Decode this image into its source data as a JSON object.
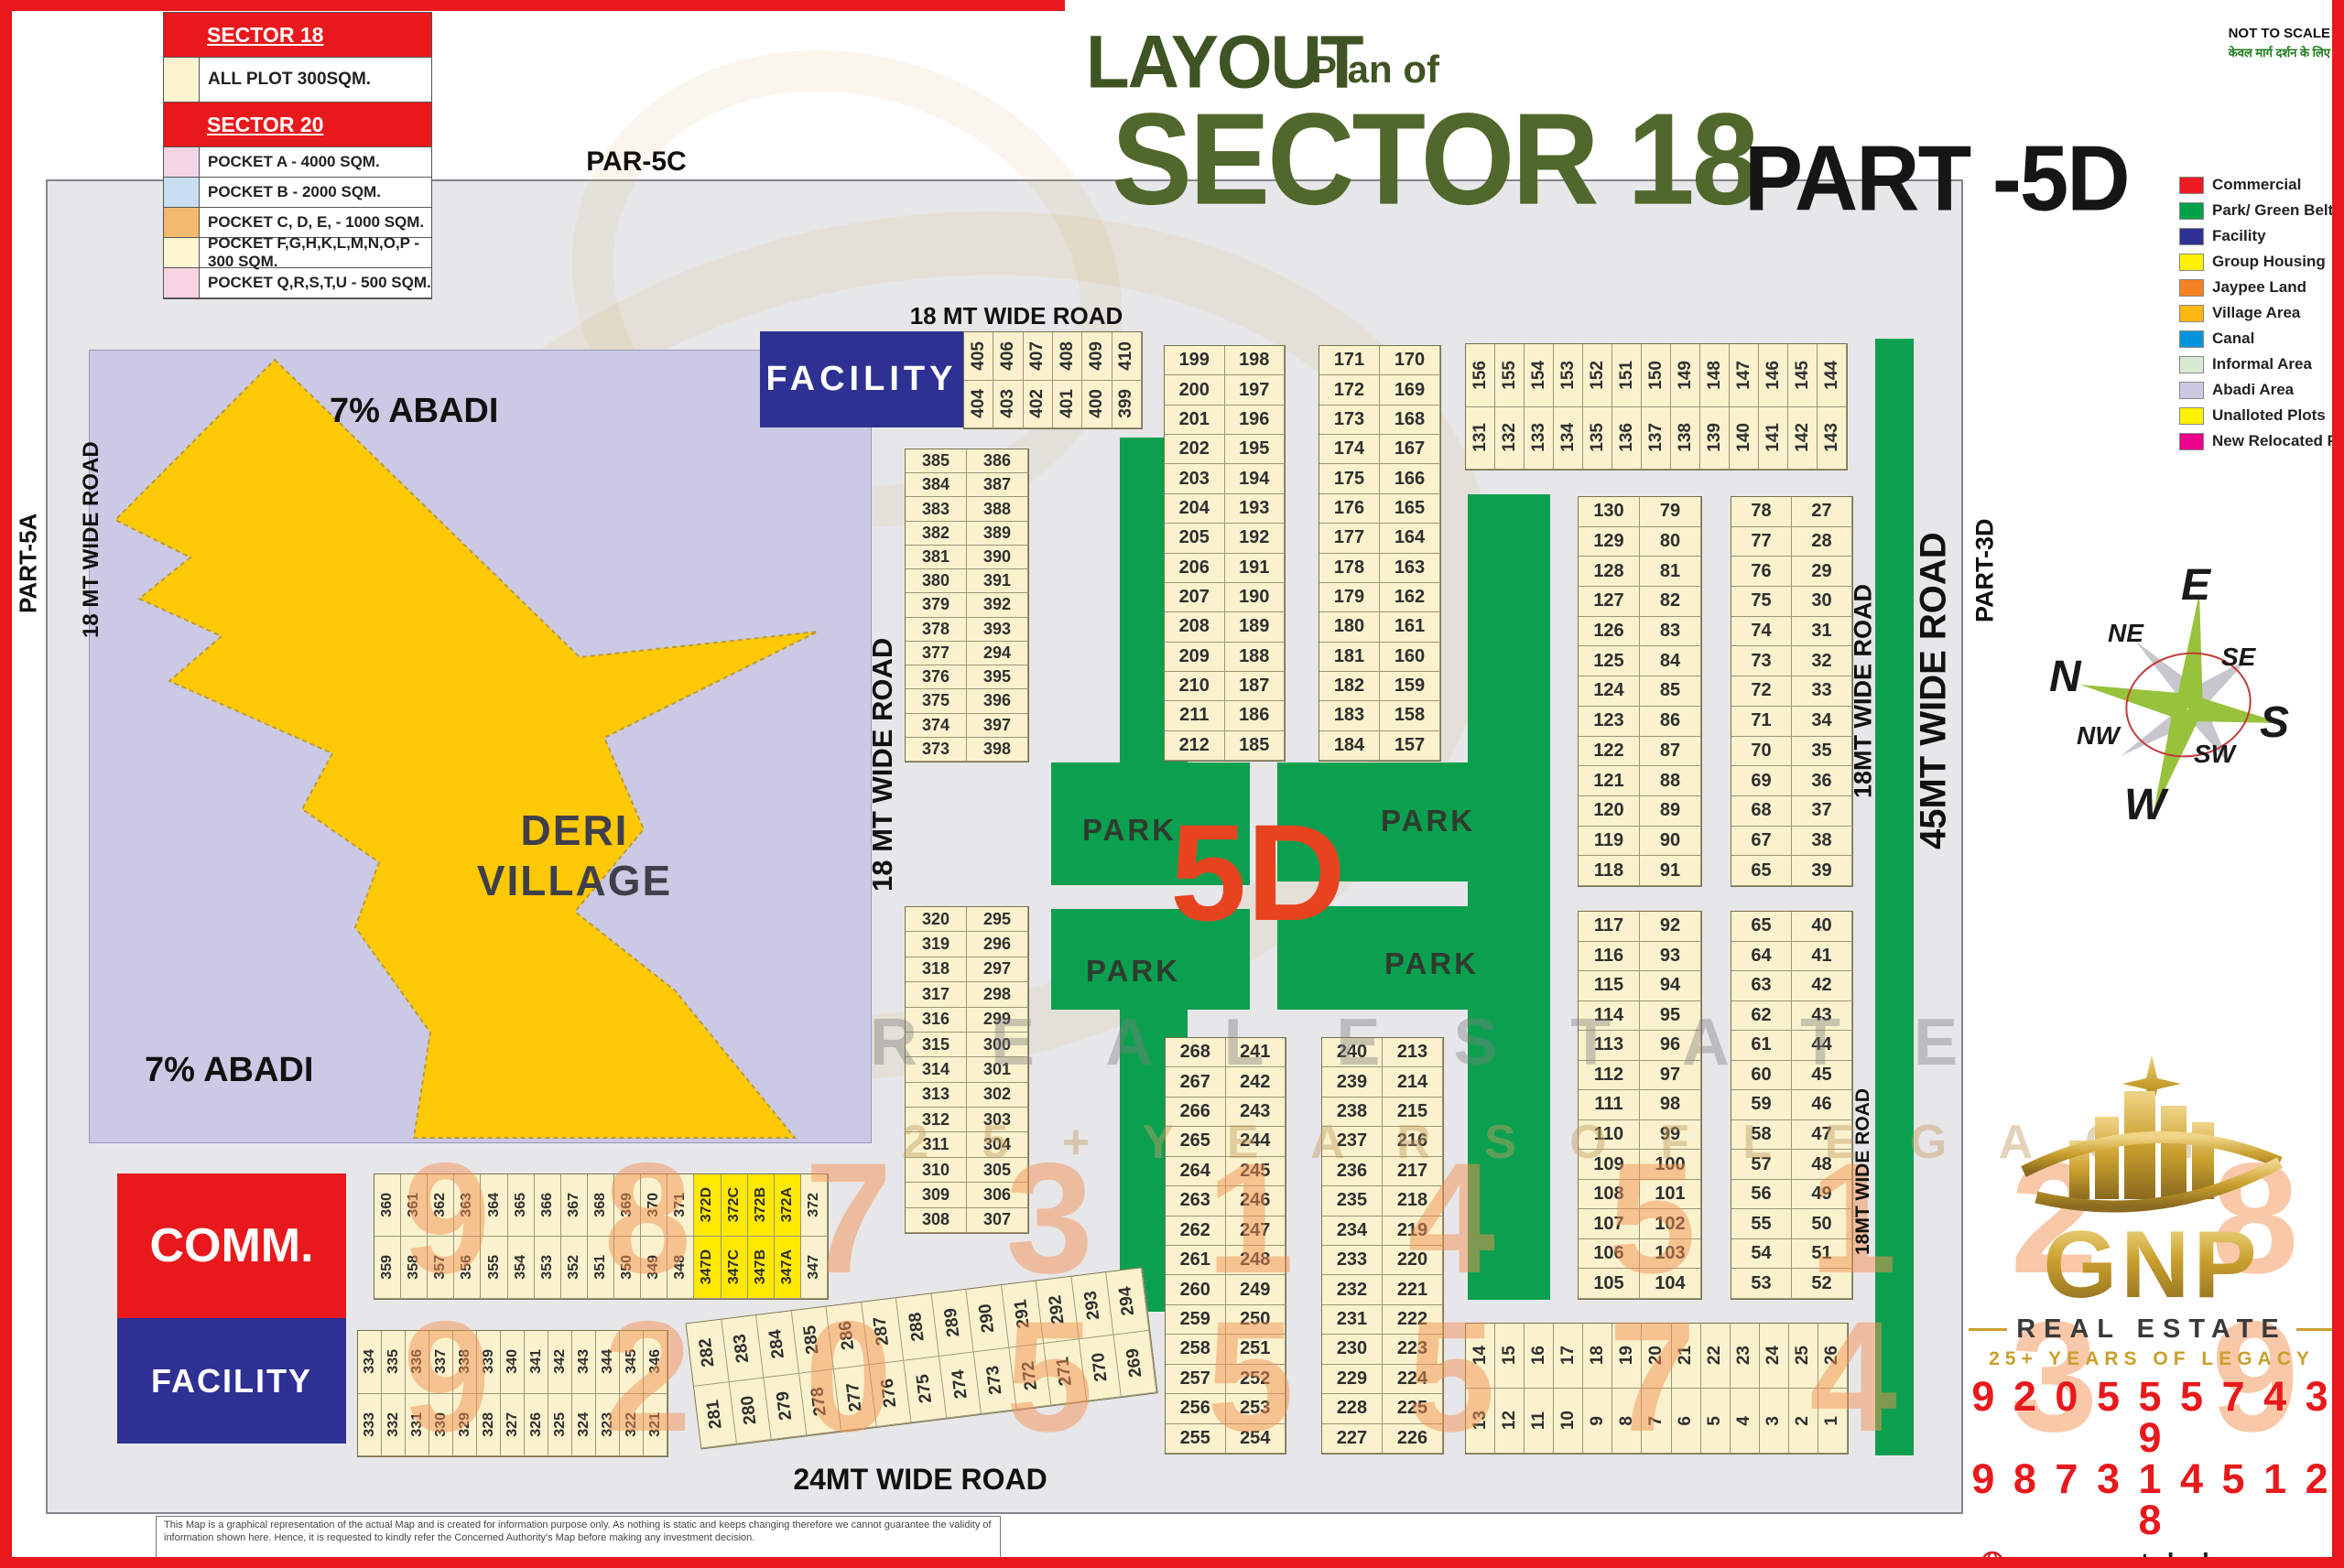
{
  "title": {
    "layout": "LAYOUT",
    "plan_of": "Plan of",
    "sector": "SECTOR 18",
    "part": "PART -5D",
    "not_to_scale": "NOT TO SCALE",
    "hindi_note": "केवल मार्ग दर्शन के लिए"
  },
  "legend_left": {
    "rows": [
      {
        "type": "header",
        "text": "SECTOR 18"
      },
      {
        "type": "item",
        "tall": true,
        "swatch": "#fbf3cf",
        "text": "ALL PLOT  300SQM."
      },
      {
        "type": "header",
        "text": "SECTOR 20"
      },
      {
        "type": "item",
        "swatch": "#f5d5e5",
        "text": "POCKET A    -   4000 SQM."
      },
      {
        "type": "item",
        "swatch": "#c9def0",
        "text": "POCKET B    -   2000 SQM."
      },
      {
        "type": "item",
        "swatch": "#f5b96e",
        "text": "POCKET C, D, E, - 1000 SQM."
      },
      {
        "type": "item",
        "swatch": "#fdf6d0",
        "text": "POCKET   F,G,H,K,L,M,N,O,P  -  300 SQM."
      },
      {
        "type": "item",
        "swatch": "#f8d3e2",
        "text": "POCKET Q,R,S,T,U   -   500 SQM."
      }
    ]
  },
  "legend_right": {
    "items": [
      {
        "color": "#ed1c24",
        "label": "Commercial"
      },
      {
        "color": "#00a14b",
        "label": "Park/ Green Belt"
      },
      {
        "color": "#2e3192",
        "label": "Facility"
      },
      {
        "color": "#fff200",
        "label": "Group Housing"
      },
      {
        "color": "#f58220",
        "label": "Jaypee Land"
      },
      {
        "color": "#fcb913",
        "label": "Village Area"
      },
      {
        "color": "#0095da",
        "label": "Canal"
      },
      {
        "color": "#d9ead3",
        "label": "Informal Area"
      },
      {
        "color": "#ccc9e2",
        "label": "Abadi Area"
      },
      {
        "color": "#fff200",
        "label": "Unalloted Plots"
      },
      {
        "color": "#ec008c",
        "label": "New Relocated Plots"
      }
    ]
  },
  "labels": {
    "par5c": "PAR-5C",
    "road_top": "18 MT WIDE ROAD",
    "part5a": "PART-5A",
    "road_left": "18 MT WIDE ROAD",
    "road_center": "18 MT WIDE ROAD",
    "abadi_top": "7% ABADI",
    "abadi_bottom": "7% ABADI",
    "deri_line1": "DERI",
    "deri_line2": "VILLAGE",
    "comm": "COMM.",
    "facility": "FACILITY",
    "park": "PARK",
    "five_d": "5D",
    "road18_right_1": "18MT WIDE ROAD",
    "road18_right_2": "18MT WIDE ROAD",
    "road_45": "45MT WIDE ROAD",
    "part3d": "PART-3D",
    "road_24": "24MT WIDE ROAD",
    "part_j": "PART-J",
    "disclaimer": "This Map is a graphical representation of the actual Map and is created for information purpose only. As nothing is static and keeps changing therefore we cannot guarantee the validity of information shown here. Hence, it is requested to kindly refer the Concerned Authority's Map before making any investment decision."
  },
  "compass": {
    "n": "N",
    "e": "E",
    "s": "S",
    "w": "W",
    "ne": "NE",
    "se": "SE",
    "sw": "SW",
    "nw": "NW"
  },
  "watermarks": {
    "line1": "R E A L   E S T A T E",
    "line2": "2 5 +   Y E A R S   O F   L E G A C Y",
    "num1": "9 8 7 3 1 4 5 1 2 8",
    "num2": "9 2 0 5 5 5 7 4 3 9"
  },
  "footer": {
    "brand": "GNP",
    "tagline": "REAL ESTATE",
    "legacy": "25+ YEARS OF LEGACY",
    "phone1": "9 2 0 5 5  5 7 4 3 9",
    "phone2": "9 8 7 3 1 4 5 1 2 8",
    "website": "gnpropertyhub.com",
    "email": "Support@gnpropertyhub.com"
  },
  "blocks": {
    "b1": {
      "left": [
        "385",
        "384",
        "383",
        "382",
        "381",
        "380",
        "379",
        "378",
        "377",
        "376",
        "375",
        "374",
        "373"
      ],
      "right": [
        "386",
        "387",
        "388",
        "389",
        "390",
        "391",
        "392",
        "393",
        "294",
        "395",
        "396",
        "397",
        "398"
      ]
    },
    "b2": {
      "left": [
        "320",
        "319",
        "318",
        "317",
        "316",
        "315",
        "314",
        "313",
        "312",
        "311",
        "310",
        "309",
        "308"
      ],
      "right": [
        "295",
        "296",
        "297",
        "298",
        "299",
        "300",
        "301",
        "302",
        "303",
        "304",
        "305",
        "306",
        "307"
      ]
    },
    "bA": {
      "left": [
        "199",
        "200",
        "201",
        "202",
        "203",
        "204",
        "205",
        "206",
        "207",
        "208",
        "209",
        "210",
        "211",
        "212"
      ],
      "right": [
        "198",
        "197",
        "196",
        "195",
        "194",
        "193",
        "192",
        "191",
        "190",
        "189",
        "188",
        "187",
        "186",
        "185"
      ]
    },
    "bB": {
      "left": [
        "171",
        "172",
        "173",
        "174",
        "175",
        "176",
        "177",
        "178",
        "179",
        "180",
        "181",
        "182",
        "183",
        "184"
      ],
      "right": [
        "170",
        "169",
        "168",
        "167",
        "166",
        "165",
        "164",
        "163",
        "162",
        "161",
        "160",
        "159",
        "158",
        "157"
      ]
    },
    "bC": {
      "left": [
        "130",
        "129",
        "128",
        "127",
        "126",
        "125",
        "124",
        "123",
        "122",
        "121",
        "120",
        "119",
        "118"
      ],
      "right": [
        "79",
        "80",
        "81",
        "82",
        "83",
        "84",
        "85",
        "86",
        "87",
        "88",
        "89",
        "90",
        "91"
      ]
    },
    "bD": {
      "left": [
        "78",
        "77",
        "76",
        "75",
        "74",
        "73",
        "72",
        "71",
        "70",
        "69",
        "68",
        "67",
        "65"
      ],
      "right": [
        "27",
        "28",
        "29",
        "30",
        "31",
        "32",
        "33",
        "34",
        "35",
        "36",
        "37",
        "38",
        "39"
      ]
    },
    "bE": {
      "left": [
        "117",
        "116",
        "115",
        "114",
        "113",
        "112",
        "111",
        "110",
        "109",
        "108",
        "107",
        "106",
        "105"
      ],
      "right": [
        "92",
        "93",
        "94",
        "95",
        "96",
        "97",
        "98",
        "99",
        "100",
        "101",
        "102",
        "103",
        "104"
      ]
    },
    "bF": {
      "left": [
        "65",
        "64",
        "63",
        "62",
        "61",
        "60",
        "59",
        "58",
        "57",
        "56",
        "55",
        "54",
        "53"
      ],
      "right": [
        "40",
        "41",
        "42",
        "43",
        "44",
        "45",
        "46",
        "47",
        "48",
        "49",
        "50",
        "51",
        "52"
      ]
    },
    "bG": {
      "left": [
        "268",
        "267",
        "266",
        "265",
        "264",
        "263",
        "262",
        "261",
        "260",
        "259",
        "258",
        "257",
        "256",
        "255"
      ],
      "right": [
        "241",
        "242",
        "243",
        "244",
        "245",
        "246",
        "247",
        "248",
        "249",
        "250",
        "251",
        "252",
        "253",
        "254"
      ]
    },
    "bH": {
      "left": [
        "240",
        "239",
        "238",
        "237",
        "236",
        "235",
        "234",
        "233",
        "232",
        "231",
        "230",
        "229",
        "228",
        "227"
      ],
      "right": [
        "213",
        "214",
        "215",
        "216",
        "217",
        "218",
        "219",
        "220",
        "221",
        "222",
        "223",
        "224",
        "225",
        "226"
      ]
    }
  },
  "strips": {
    "s405": {
      "top": [
        "405",
        "406",
        "407",
        "408",
        "409",
        "410"
      ],
      "bottom": [
        "404",
        "403",
        "402",
        "401",
        "400",
        "399"
      ]
    },
    "s131": {
      "top": [
        "156",
        "155",
        "154",
        "153",
        "152",
        "151",
        "150",
        "149",
        "148",
        "147",
        "146",
        "145",
        "144"
      ],
      "bottom": [
        "131",
        "132",
        "133",
        "134",
        "135",
        "136",
        "137",
        "138",
        "139",
        "140",
        "141",
        "142",
        "143"
      ]
    },
    "s360": {
      "top": [
        "360",
        "361",
        "362",
        "363",
        "364",
        "365",
        "366",
        "367",
        "368",
        "369",
        "370",
        "371",
        "372D",
        "372C",
        "372B",
        "372A",
        "372"
      ],
      "bottom": [
        "359",
        "358",
        "357",
        "356",
        "355",
        "354",
        "353",
        "352",
        "351",
        "350",
        "349",
        "348",
        "347D",
        "347C",
        "347B",
        "347A",
        "347"
      ],
      "highlight": [
        12,
        13,
        14,
        15
      ]
    },
    "s334": {
      "top": [
        "334",
        "335",
        "336",
        "337",
        "338",
        "339",
        "340",
        "341",
        "342",
        "343",
        "344",
        "345",
        "346"
      ],
      "bottom": [
        "333",
        "332",
        "331",
        "330",
        "329",
        "328",
        "327",
        "326",
        "325",
        "324",
        "323",
        "322",
        "321"
      ]
    },
    "s282": {
      "top": [
        "282",
        "283",
        "284",
        "285",
        "286",
        "287",
        "288",
        "289",
        "290",
        "291",
        "292",
        "293",
        "294"
      ],
      "bottom": [
        "281",
        "280",
        "279",
        "278",
        "277",
        "276",
        "275",
        "274",
        "273",
        "272",
        "271",
        "270",
        "269"
      ]
    },
    "s14": {
      "top": [
        "14",
        "15",
        "16",
        "17",
        "18",
        "19",
        "20",
        "21",
        "22",
        "23",
        "24",
        "25",
        "26"
      ],
      "bottom": [
        "13",
        "12",
        "11",
        "10",
        "9",
        "8",
        "7",
        "6",
        "5",
        "4",
        "3",
        "2",
        "1"
      ]
    }
  }
}
